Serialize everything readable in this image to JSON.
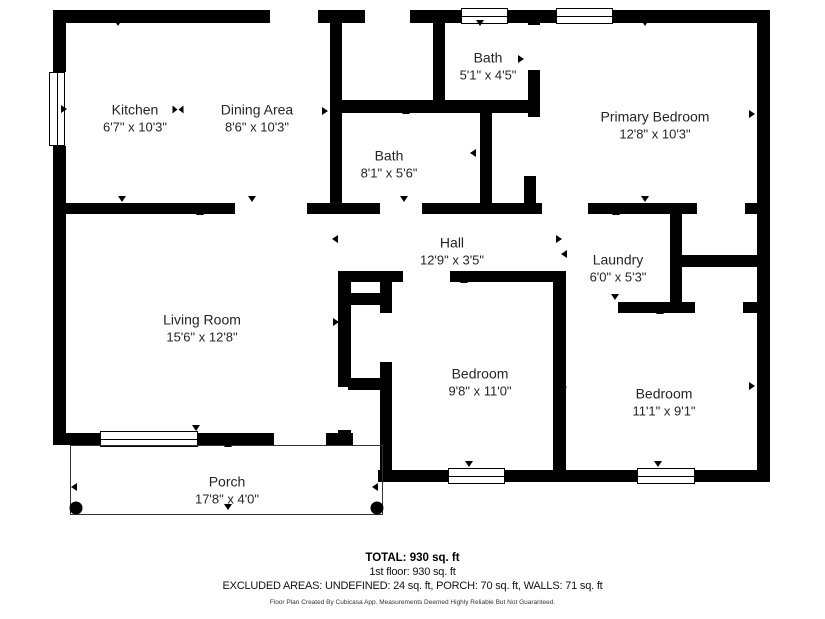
{
  "footer": {
    "total": "TOTAL: 930 sq. ft",
    "floor": "1st floor: 930 sq. ft",
    "excluded": "EXCLUDED AREAS: UNDEFINED: 24 sq. ft, PORCH: 70 sq. ft, WALLS: 71 sq. ft",
    "attribution": "Floor Plan Created By Cubicasa App. Measurements Deemed Highly Reliable But Not Guaranteed."
  },
  "floorplan": {
    "wall_color": "#000000",
    "background_color": "#ffffff",
    "rooms": [
      {
        "name": "Kitchen",
        "dims": "6'7\" x 10'3\"",
        "cx": 135,
        "cy": 118
      },
      {
        "name": "Dining Area",
        "dims": "8'6\" x 10'3\"",
        "cx": 257,
        "cy": 118
      },
      {
        "name": "Bath",
        "dims": "5'1\" x 4'5\"",
        "cx": 488,
        "cy": 66
      },
      {
        "name": "Primary Bedroom",
        "dims": "12'8\" x 10'3\"",
        "cx": 655,
        "cy": 125
      },
      {
        "name": "Bath",
        "dims": "8'1\" x 5'6\"",
        "cx": 389,
        "cy": 164
      },
      {
        "name": "Hall",
        "dims": "12'9\" x 3'5\"",
        "cx": 452,
        "cy": 251
      },
      {
        "name": "Laundry",
        "dims": "6'0\" x 5'3\"",
        "cx": 618,
        "cy": 268
      },
      {
        "name": "Living Room",
        "dims": "15'6\" x 12'8\"",
        "cx": 202,
        "cy": 328
      },
      {
        "name": "Bedroom",
        "dims": "9'8\" x 11'0\"",
        "cx": 480,
        "cy": 382
      },
      {
        "name": "Bedroom",
        "dims": "11'1\" x 9'1\"",
        "cx": 664,
        "cy": 402
      },
      {
        "name": "Porch",
        "dims": "17'8\" x 4'0\"",
        "cx": 227,
        "cy": 490
      }
    ],
    "walls": [
      [
        53,
        10,
        217,
        13
      ],
      [
        318,
        10,
        47,
        13
      ],
      [
        410,
        10,
        360,
        13
      ],
      [
        53,
        10,
        13,
        62
      ],
      [
        53,
        146,
        13,
        299
      ],
      [
        757,
        10,
        13,
        472
      ],
      [
        53,
        433,
        47,
        12
      ],
      [
        198,
        433,
        76,
        12
      ],
      [
        326,
        433,
        27,
        12
      ],
      [
        378,
        470,
        70,
        12
      ],
      [
        504,
        470,
        134,
        12
      ],
      [
        694,
        470,
        76,
        12
      ],
      [
        330,
        10,
        12,
        204
      ],
      [
        433,
        23,
        12,
        90
      ],
      [
        330,
        100,
        210,
        13
      ],
      [
        528,
        10,
        12,
        15
      ],
      [
        528,
        70,
        12,
        47
      ],
      [
        480,
        112,
        12,
        101
      ],
      [
        524,
        176,
        12,
        37
      ],
      [
        65,
        203,
        170,
        11
      ],
      [
        307,
        203,
        73,
        11
      ],
      [
        422,
        203,
        120,
        11
      ],
      [
        588,
        203,
        109,
        11
      ],
      [
        745,
        203,
        25,
        11
      ],
      [
        670,
        214,
        12,
        98
      ],
      [
        682,
        255,
        76,
        12
      ],
      [
        618,
        302,
        77,
        11
      ],
      [
        743,
        302,
        27,
        11
      ],
      [
        338,
        271,
        65,
        11
      ],
      [
        450,
        271,
        116,
        11
      ],
      [
        553,
        271,
        13,
        211
      ],
      [
        338,
        271,
        13,
        116
      ],
      [
        338,
        430,
        13,
        15
      ],
      [
        380,
        271,
        12,
        42
      ],
      [
        380,
        362,
        12,
        120
      ],
      [
        348,
        293,
        32,
        12
      ],
      [
        348,
        378,
        32,
        12
      ]
    ],
    "windows": [
      [
        461,
        8,
        47,
        16,
        "h"
      ],
      [
        556,
        8,
        57,
        16,
        "h"
      ],
      [
        49,
        72,
        16,
        74,
        "v"
      ],
      [
        100,
        431,
        98,
        16,
        "h"
      ],
      [
        448,
        468,
        57,
        16,
        "h"
      ],
      [
        637,
        468,
        58,
        16,
        "h"
      ]
    ],
    "porch": {
      "outline": [
        70,
        445,
        313,
        70
      ],
      "posts": [
        [
          76,
          508
        ],
        [
          377,
          508
        ]
      ]
    },
    "markers": [
      {
        "x": 118,
        "y": 23,
        "t": "down"
      },
      {
        "x": 480,
        "y": 23,
        "t": "down"
      },
      {
        "x": 645,
        "y": 23,
        "t": "down"
      },
      {
        "x": 122,
        "y": 199,
        "t": "down"
      },
      {
        "x": 252,
        "y": 199,
        "t": "down"
      },
      {
        "x": 404,
        "y": 199,
        "t": "down"
      },
      {
        "x": 645,
        "y": 199,
        "t": "down"
      },
      {
        "x": 615,
        "y": 297,
        "t": "down"
      },
      {
        "x": 469,
        "y": 464,
        "t": "down"
      },
      {
        "x": 658,
        "y": 464,
        "t": "down"
      },
      {
        "x": 196,
        "y": 428,
        "t": "down"
      },
      {
        "x": 228,
        "y": 507,
        "t": "down"
      },
      {
        "x": 200,
        "y": 212,
        "t": "up"
      },
      {
        "x": 406,
        "y": 111,
        "t": "up"
      },
      {
        "x": 616,
        "y": 212,
        "t": "up"
      },
      {
        "x": 464,
        "y": 280,
        "t": "up"
      },
      {
        "x": 660,
        "y": 311,
        "t": "up"
      },
      {
        "x": 228,
        "y": 444,
        "t": "up"
      },
      {
        "x": 64,
        "y": 109,
        "t": "right"
      },
      {
        "x": 325,
        "y": 111,
        "t": "right"
      },
      {
        "x": 521,
        "y": 59,
        "t": "right"
      },
      {
        "x": 752,
        "y": 114,
        "t": "right"
      },
      {
        "x": 752,
        "y": 386,
        "t": "right"
      },
      {
        "x": 559,
        "y": 239,
        "t": "right"
      },
      {
        "x": 336,
        "y": 322,
        "t": "right"
      },
      {
        "x": 388,
        "y": 374,
        "t": "right"
      },
      {
        "x": 564,
        "y": 387,
        "t": "right"
      },
      {
        "x": 335,
        "y": 151,
        "t": "left"
      },
      {
        "x": 473,
        "y": 153,
        "t": "left"
      },
      {
        "x": 335,
        "y": 239,
        "t": "left"
      },
      {
        "x": 564,
        "y": 254,
        "t": "left"
      },
      {
        "x": 74,
        "y": 487,
        "t": "left"
      },
      {
        "x": 375,
        "y": 487,
        "t": "left"
      },
      {
        "x": 178,
        "y": 110,
        "t": "bowtie"
      }
    ]
  }
}
